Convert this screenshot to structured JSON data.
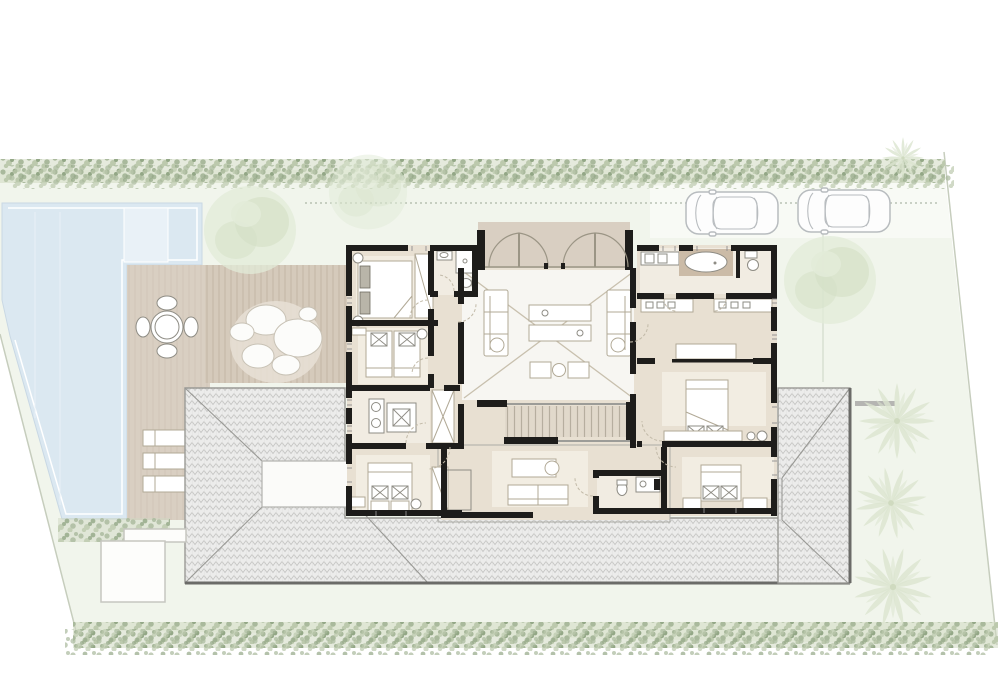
{
  "meta": {
    "drawing_type": "architectural-site-floor-plan",
    "storey": "upper floor over tiled hip roofs",
    "visible_text": "none"
  },
  "palette": {
    "paper": "#ffffff",
    "wall": "#1e1d1b",
    "site": "#f1f5ec",
    "drive": "#f8faf5",
    "pool": "#dbe8f1",
    "poolinner": "#e9f1f7",
    "poolline": "#c9d8e4",
    "deck": "#d9cfc2",
    "slatdeck": "#d5cabb",
    "slatline": "#c3b5a4",
    "floor": "#e8e0d2",
    "floorlight": "#f1ece2",
    "court": "#f7f6f2",
    "rug": "#f2ede2",
    "stairfill": "#e1d9cb",
    "tread": "#b6ae9f",
    "furn": "#b1a996",
    "fix": "#8e8c84",
    "door": "#c2baa8",
    "door2": "#9b9585",
    "cross": "#c8c0ae",
    "glaze": "#8d8d8d",
    "roofbase": "#ececeb",
    "roofline": "#c6c6c4",
    "roofedge": "#999995",
    "roofdark": "#6b6b68",
    "hedge1": "#a9b99c",
    "hedge2": "#bcc9ad",
    "hedge3": "#93a786",
    "hedgebase": "#cfd8c1",
    "tree1": "#e2ebd8",
    "tree2": "#d3e0c5",
    "palm": "#dce5d0",
    "car": "#b8bcbf",
    "bound": "#c6cdbd",
    "dotline": "#9aa795",
    "faint": "#ccd5c5",
    "woodtub": "#cbbba7",
    "darkpillow": "#b9b5a9"
  },
  "inventory": {
    "pool": "swimming-pool",
    "pool_deck": {
      "sun_loungers": 3,
      "dining_table": {
        "seats": 4
      }
    },
    "timber_deck": {
      "feature": "boulder-cluster"
    },
    "house": {
      "bedrooms": 4,
      "master_suite": {
        "bathtub": 1,
        "double_vanity": true,
        "walk_in_closet": true
      },
      "bathrooms": 4,
      "double_height_living": true,
      "folding_entrance_doors": 4,
      "stairs": 1
    },
    "parking": {
      "cars": 2
    },
    "vegetation": {
      "palm_trees": 4,
      "canopy_trees": 3,
      "hedges": 2,
      "shrub_row": 1
    },
    "roof": {
      "type": "hipped-tile",
      "skylight_panels": 1
    },
    "outbuilding": {
      "shed": 1
    }
  }
}
